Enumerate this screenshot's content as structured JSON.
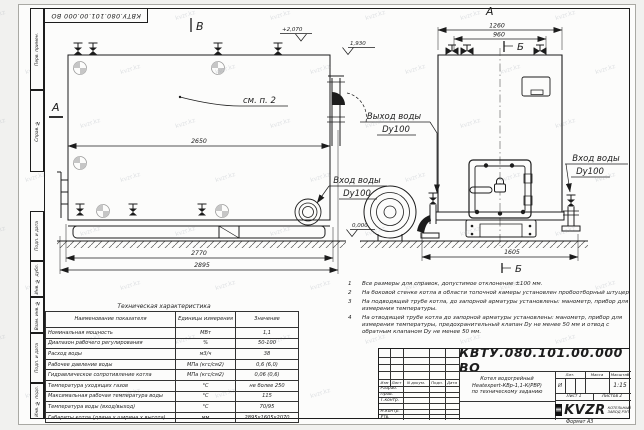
{
  "stamp": {
    "doc_number_top": "КВТУ.080.101.00.000 ВО"
  },
  "margin": {
    "labels": [
      "Перв. примен.",
      "Справ. №",
      "Подп. и дата",
      "Инв. № дубл.",
      "Взам. инв. №",
      "Подп. и дата",
      "Инв. № подл."
    ]
  },
  "watermark": {
    "text": "kvzr.kz"
  },
  "drawing": {
    "view_b_label": "В",
    "section_a_label": "А",
    "view_a_label": "А",
    "section_b_top": "Б",
    "section_b_bottom": "Б",
    "see_note": "см. п. 2",
    "elev_top": "+2,070",
    "elev_pipe": "1,930",
    "elev_zero": "0,000",
    "dim_2650": "2650",
    "dim_2770": "2770",
    "dim_2895": "2895",
    "dim_1260": "1260",
    "dim_960": "960",
    "dim_1605": "1605",
    "water_out_line1": "Выход воды",
    "water_out_line2": "Dy100",
    "water_in_left_line1": "Вход воды",
    "water_in_left_line2": "Dy100",
    "water_in_right_line1": "Вход воды",
    "water_in_right_line2": "Dy100"
  },
  "notes": {
    "items": [
      {
        "num": "1",
        "text": "Все размеры для справок, допустимое отклонение ±100 мм."
      },
      {
        "num": "2",
        "text": "На боковой стенке котла в области топочной камеры установлен пробоотборный штуцер"
      },
      {
        "num": "3",
        "text": "На подводящей трубе котла, до запорной арматуры установлены: манометр, прибор для измерения температуры."
      },
      {
        "num": "4",
        "text": "На отводящей трубе котла до запорной арматуры установлены: манометр, прибор для измерения температуры, предохранительный клапан Dу не менее 50 мм и отвод с обратным клапаном Dу не менее 50 мм."
      }
    ]
  },
  "tech_table": {
    "title": "Техническая характеристика",
    "headers": [
      "Наименование показателя",
      "Единицы измерения",
      "Значение"
    ],
    "rows": [
      [
        "Номинальная мощность",
        "МВт",
        "1,1"
      ],
      [
        "Диапазон рабочего регулирования",
        "%",
        "50-100"
      ],
      [
        "Расход воды",
        "м3/ч",
        "38"
      ],
      [
        "Рабочее давление воды",
        "МПа (кгс/см2)",
        "0,6 (6,0)"
      ],
      [
        "Гидравлическое сопротивление котла",
        "МПа (кгс/см2)",
        "0,06 (0,6)"
      ],
      [
        "Температура уходящих газов",
        "°С",
        "не более 250"
      ],
      [
        "Максимальная рабочая температура воды",
        "°С",
        "115"
      ],
      [
        "Температура воды (вход/выход)",
        "°С",
        "70/95"
      ],
      [
        "Габариты котла (длина х ширина х высота)",
        "мм",
        "2895х1605х2070"
      ]
    ]
  },
  "title_block": {
    "doc_number": "КВТУ.080.101.00.000 ВО",
    "rev_headers": [
      "Изм",
      "Лист",
      "N докум.",
      "Подп.",
      "Дата"
    ],
    "sign_rows": [
      "Разраб.",
      "Пров.",
      "Т.контр.",
      "",
      "Н.контр.",
      "Утв."
    ],
    "description_line1": "Котел водогрейный",
    "description_line2": "Heatexpert-КВр-1,1-К(РВР)",
    "description_line3": "по техническому заданию",
    "lit_header": "Лит.",
    "mass_header": "Масса",
    "scale_header": "Масштаб",
    "lit_value": "И",
    "scale_value": "1:15",
    "sheet_text": "Лист 1",
    "sheets_text": "Листов 2",
    "company_logo": "KVZR",
    "company_name_line1": "КОТЕЛЬНЫЙ",
    "company_name_line2": "ЗАВОД РЭП",
    "format_label": "Формат  А3"
  }
}
